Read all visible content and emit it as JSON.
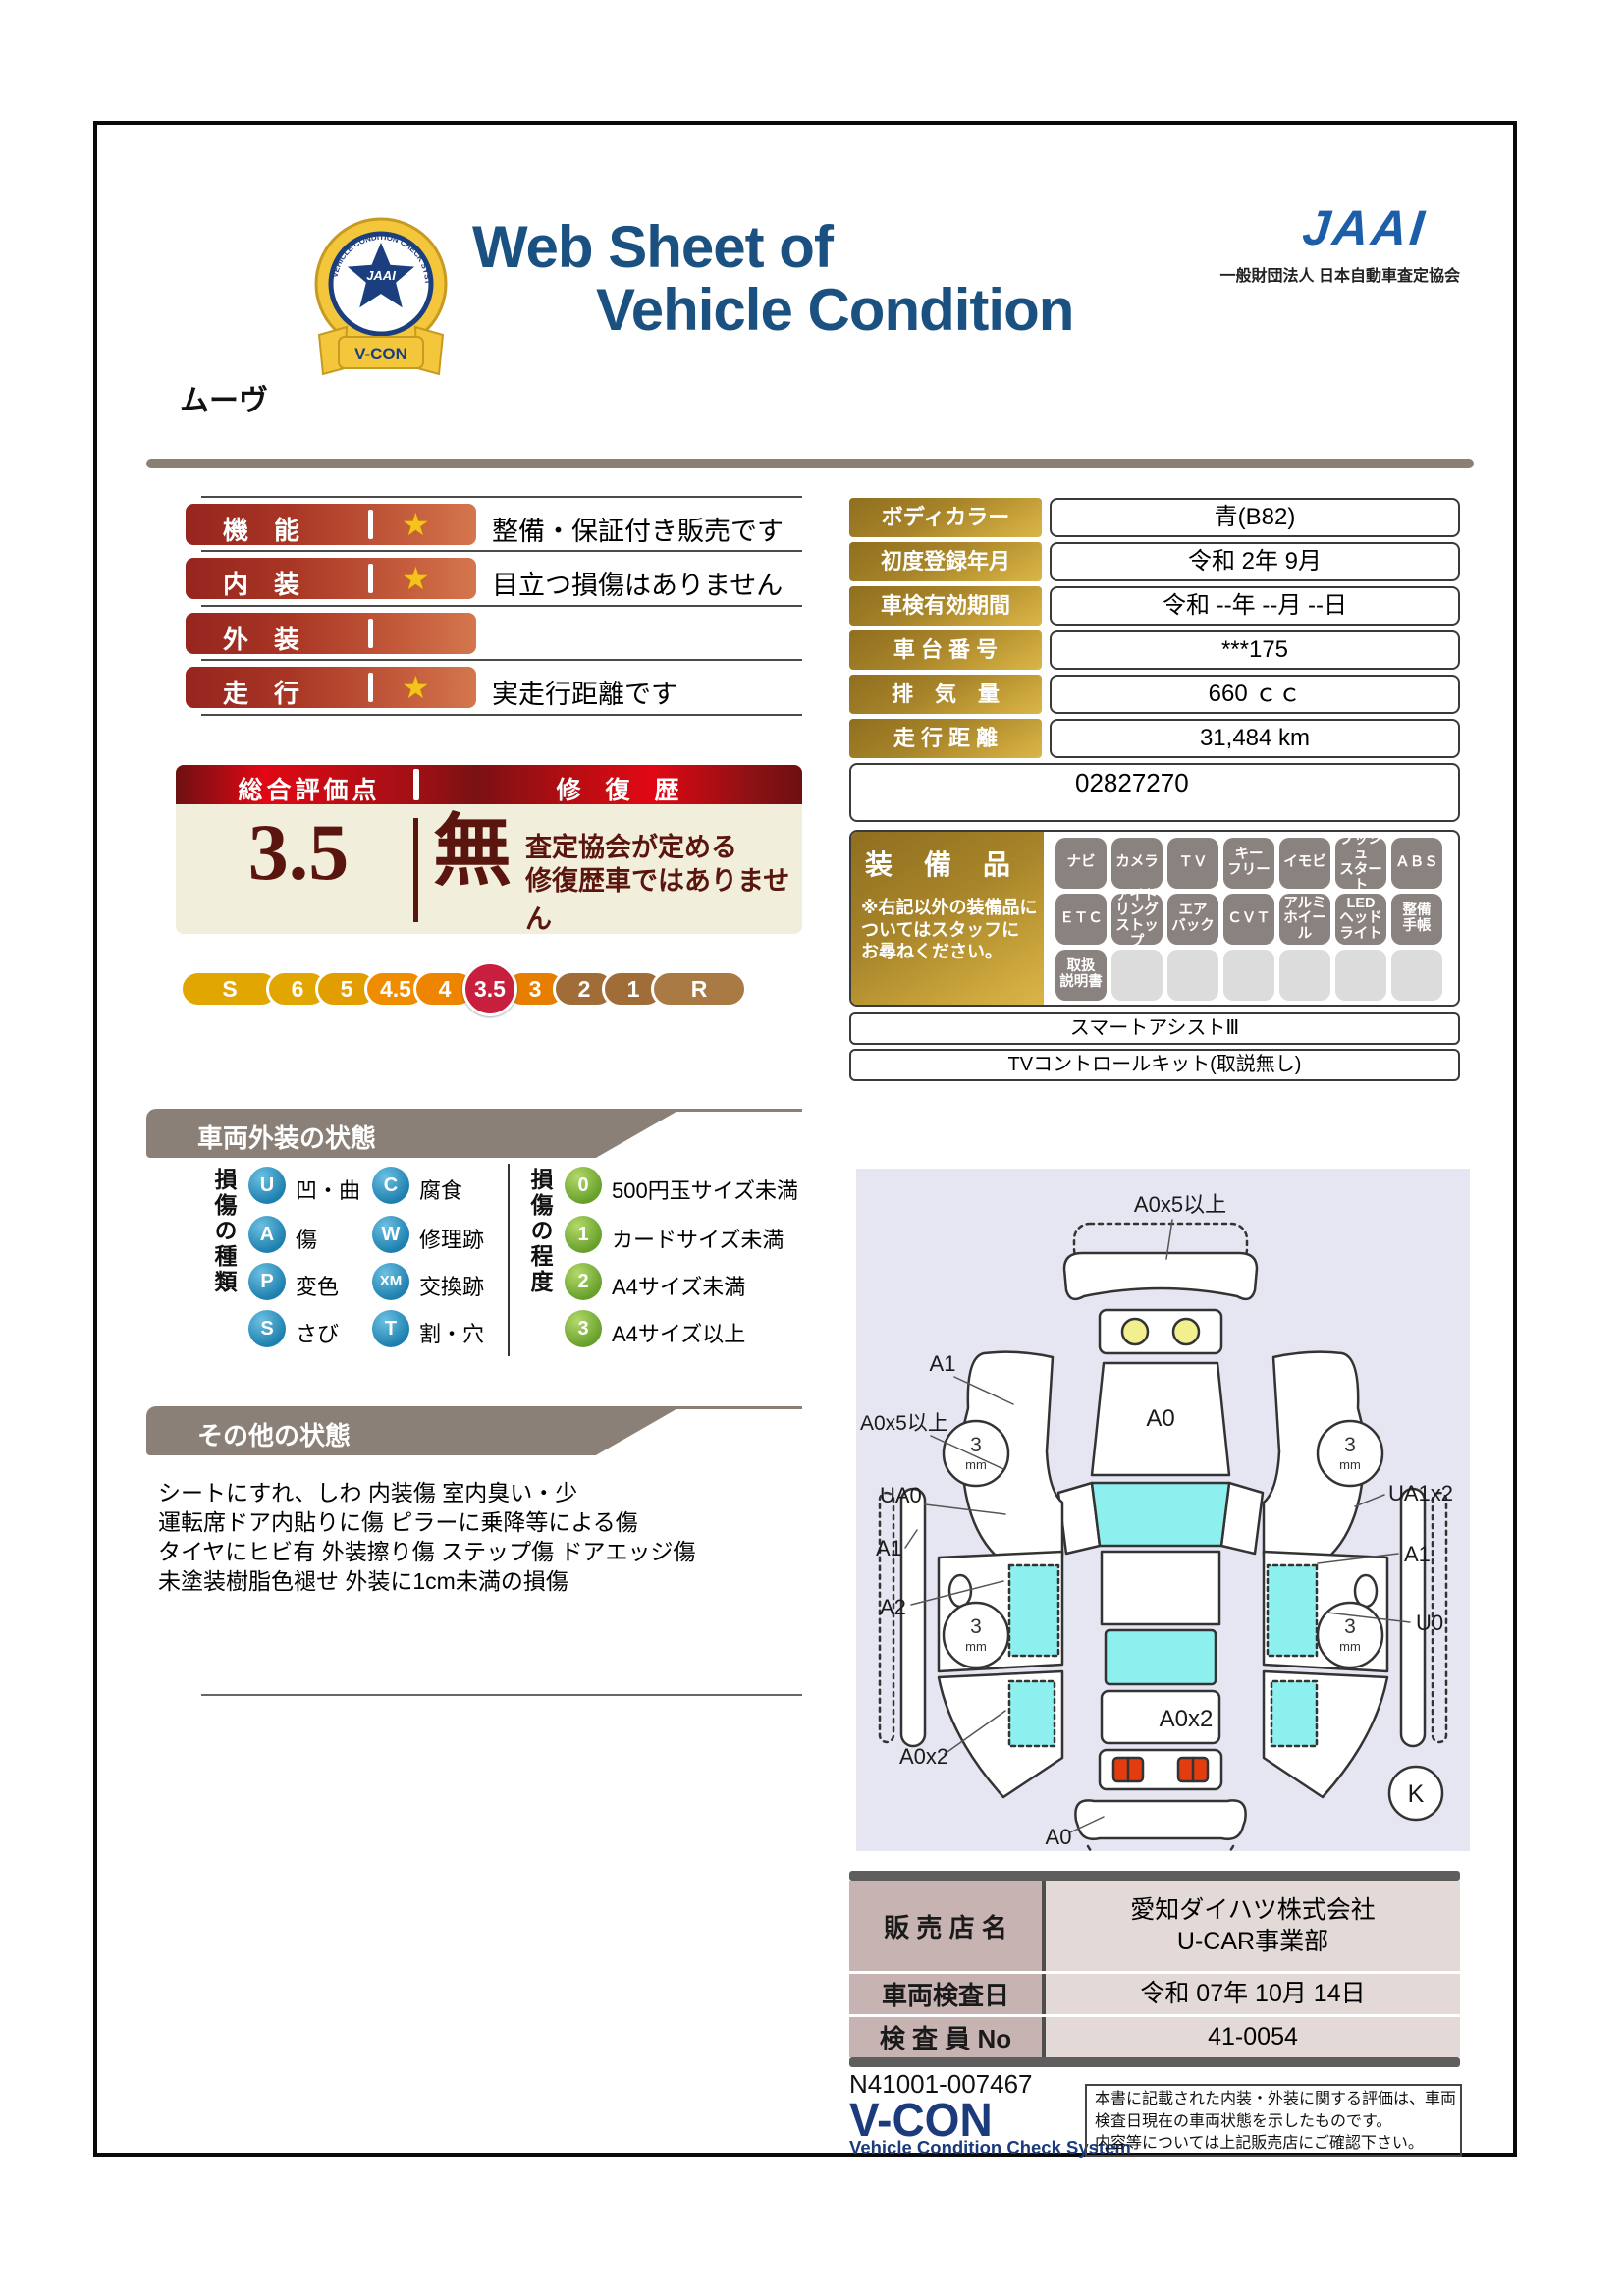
{
  "header": {
    "title_line1": "Web Sheet of",
    "title_line2": "Vehicle Condition",
    "jaai_logo": "JAAI",
    "jaai_subtitle": "一般財団法人 日本自動車査定協会",
    "emblem_center": "JAAI",
    "emblem_ring_text": "VEHICLE CONDITION CHECK SYSTEM",
    "emblem_ribbon": "V-CON",
    "vehicle_name": "ムーヴ"
  },
  "ratings": [
    {
      "label": "機　能",
      "star": true,
      "note": "整備・保証付き販売です"
    },
    {
      "label": "内　装",
      "star": true,
      "note": "目立つ損傷はありません"
    },
    {
      "label": "外　装",
      "star": false,
      "note": ""
    },
    {
      "label": "走　行",
      "star": true,
      "note": "実走行距離です"
    }
  ],
  "overall": {
    "score_header": "総合評価点",
    "repair_header": "修　復　歴",
    "score": "3.5",
    "repair_value": "無",
    "repair_note_line1": "査定協会が定める",
    "repair_note_line2": "修復歴車ではありません",
    "scale": [
      "S",
      "6",
      "5",
      "4.5",
      "4",
      "3.5",
      "3",
      "2",
      "1",
      "R"
    ],
    "scale_selected": "3.5",
    "scale_colors": [
      "#e2a600",
      "#e2a600",
      "#e29e00",
      "#f08c00",
      "#ee8400",
      "#c91f3e",
      "#e87e00",
      "#a06c38",
      "#a06c38",
      "#aa7a45"
    ]
  },
  "vehicle_info": {
    "rows": [
      {
        "label": "ボディカラー",
        "value": "青(B82)"
      },
      {
        "label": "初度登録年月",
        "value": "令和 2年 9月"
      },
      {
        "label": "車検有効期間",
        "value": "令和 --年 --月 --日"
      },
      {
        "label": "車 台 番 号",
        "value": "***175"
      },
      {
        "label": "排　気　量",
        "value": "660 ｃｃ"
      },
      {
        "label": "走 行 距 離",
        "value": "31,484 km"
      }
    ],
    "reference_number": "02827270"
  },
  "equipment": {
    "title": "装　備　品",
    "note": "※右記以外の装備品に\nついてはスタッフに\nお尋ねください。",
    "chips": [
      {
        "label": "ナビ",
        "active": true
      },
      {
        "label": "カメラ",
        "active": true
      },
      {
        "label": "ＴＶ",
        "active": true
      },
      {
        "label": "キー\nフリー",
        "active": true
      },
      {
        "label": "イモビ",
        "active": true
      },
      {
        "label": "プッシュ\nスタート",
        "active": true
      },
      {
        "label": "ＡＢＳ",
        "active": true
      },
      {
        "label": "ＥＴＣ",
        "active": true
      },
      {
        "label": "アイド\nリング\nストップ",
        "active": true
      },
      {
        "label": "エア\nバック",
        "active": true
      },
      {
        "label": "ＣＶＴ",
        "active": true
      },
      {
        "label": "アルミ\nホイール",
        "active": true
      },
      {
        "label": "LED\nヘッド\nライト",
        "active": true
      },
      {
        "label": "整備\n手帳",
        "active": true
      },
      {
        "label": "取扱\n説明書",
        "active": true
      },
      {
        "label": "",
        "active": false
      },
      {
        "label": "",
        "active": false
      },
      {
        "label": "",
        "active": false
      },
      {
        "label": "",
        "active": false
      },
      {
        "label": "",
        "active": false
      },
      {
        "label": "",
        "active": false
      }
    ],
    "extra_rows": [
      "スマートアシストⅢ",
      "TVコントロールキット(取説無し)"
    ]
  },
  "exterior_section": {
    "title": "車両外装の状態",
    "type_group_label": "損傷の種類",
    "types": [
      {
        "code": "U",
        "label": "凹・曲"
      },
      {
        "code": "C",
        "label": "腐食"
      },
      {
        "code": "A",
        "label": "傷"
      },
      {
        "code": "W",
        "label": "修理跡"
      },
      {
        "code": "P",
        "label": "変色"
      },
      {
        "code": "XM",
        "label": "交換跡"
      },
      {
        "code": "S",
        "label": "さび"
      },
      {
        "code": "T",
        "label": "割・穴"
      }
    ],
    "degree_group_label": "損傷の程度",
    "degrees": [
      {
        "code": "0",
        "label": "500円玉サイズ未満"
      },
      {
        "code": "1",
        "label": "カードサイズ未満"
      },
      {
        "code": "2",
        "label": "A4サイズ未満"
      },
      {
        "code": "3",
        "label": "A4サイズ以上"
      }
    ]
  },
  "other_section": {
    "title": "その他の状態",
    "lines": [
      "シートにすれ、しわ 内装傷 室内臭い・少",
      "運転席ドア内貼りに傷 ピラーに乗降等による傷",
      "タイヤにヒビ有 外装擦り傷 ステップ傷 ドアエッジ傷",
      "未塗装樹脂色褪せ 外装に1cm未満の損傷"
    ]
  },
  "diagram": {
    "labels": {
      "front_bumper": "A0x5以上",
      "front_left_fender": "A1",
      "hood": "A0",
      "left_door_outer": "A0x5以上",
      "left_front_door": "UA0",
      "right_front_door": "UA1x2",
      "left_sill": "A1",
      "left_rear_quarter": "A2",
      "right_rear_quarter": "A1",
      "right_underbody": "U0",
      "left_rear_corner": "A0x2",
      "trunk": "A0x2",
      "rear_bumper": "A0",
      "paint_depth": "3",
      "paint_depth_unit": "mm",
      "key_mark": "K"
    }
  },
  "dealer": {
    "rows": [
      {
        "label": "販 売 店 名",
        "value": "愛知ダイハツ株式会社\nU-CAR事業部"
      },
      {
        "label": "車両検査日",
        "value": "令和 07年 10月 14日"
      },
      {
        "label": "検 査 員 No",
        "value": "41-0054"
      }
    ]
  },
  "footer": {
    "document_number": "N41001-007467",
    "vcon_logo": "V-CON",
    "vcon_subtitle": "Vehicle Condition Check System",
    "disclaimer_lines": [
      "本書に記載された内装・外装に関する評価は、車両",
      "検査日現在の車両状態を示したものです。",
      "内容等については上記販売店にご確認下さい。"
    ]
  },
  "colors": {
    "title_navy": "#1a5180",
    "jaai_blue": "#1c5fa8",
    "rating_red": "#a83524",
    "gold": "#b8923a",
    "selected_grade": "#c91f3e",
    "beige_panel": "#f2eedc",
    "section_gray": "#8b8077",
    "diagram_bg": "#e5e6f2",
    "window_cyan": "#8df0ee"
  }
}
